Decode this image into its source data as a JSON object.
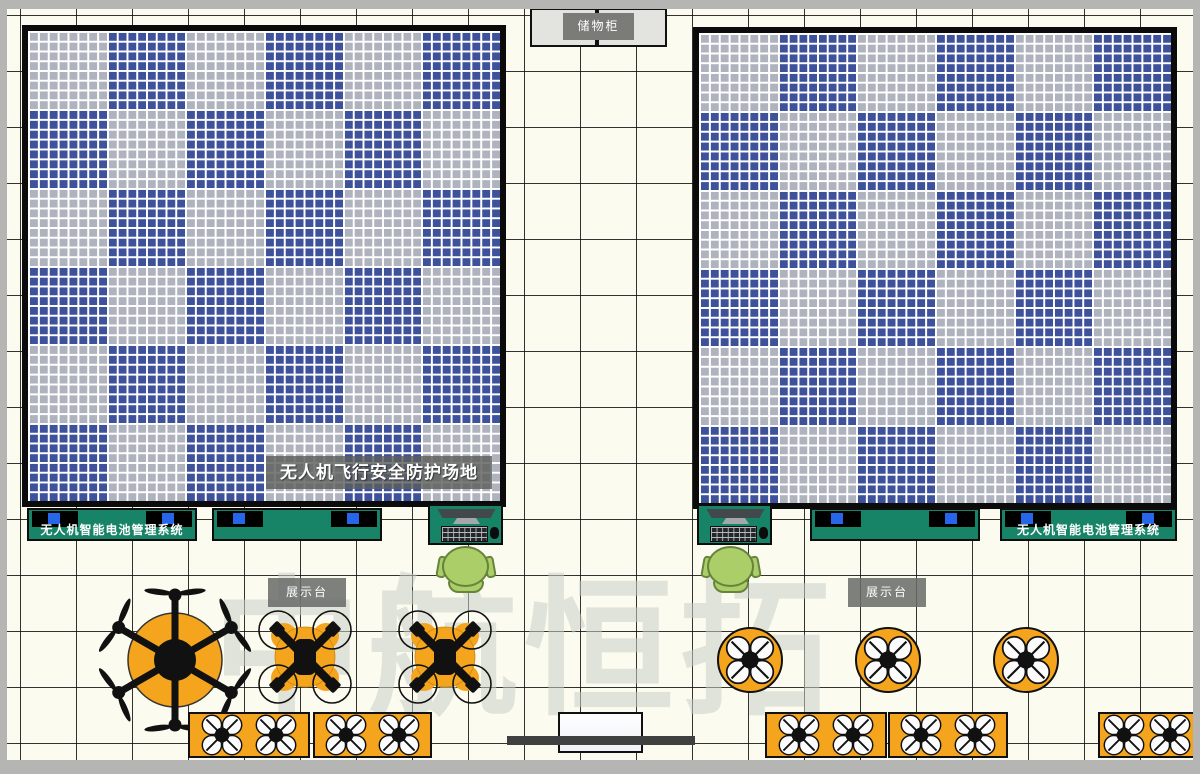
{
  "watermark": "中航恒拓",
  "storage_cabinet": {
    "label": "储物柜"
  },
  "flight_cages": {
    "label": "无人机飞行安全防护场地",
    "count": 2,
    "rows": 6,
    "cols": 6,
    "mesh_cells_per_block": 8
  },
  "battery_tables": {
    "label": "无人机智能电池管理系统",
    "count": 4
  },
  "display_stands": {
    "label": "展示台",
    "count": 2
  },
  "equipment": {
    "hexacopter_count": 1,
    "x_quadcopter_count": 2,
    "landing_pad_count": 3,
    "bench_drone_count": 10,
    "workstation_count": 2,
    "chair_count": 2
  },
  "colors": {
    "floor": "#fcfbef",
    "outer_wall": "#b5b6b3",
    "mesh_blue": "#3e519b",
    "mesh_gray": "#afb3bd",
    "mesh_line": "#ffffff",
    "table_teal": "#178468",
    "screen_blue": "#2666e8",
    "accent_orange": "#f4a51d",
    "chair_green": "#abce69",
    "label_gray": "#7b7b78",
    "dark_bar": "#3f4040"
  }
}
